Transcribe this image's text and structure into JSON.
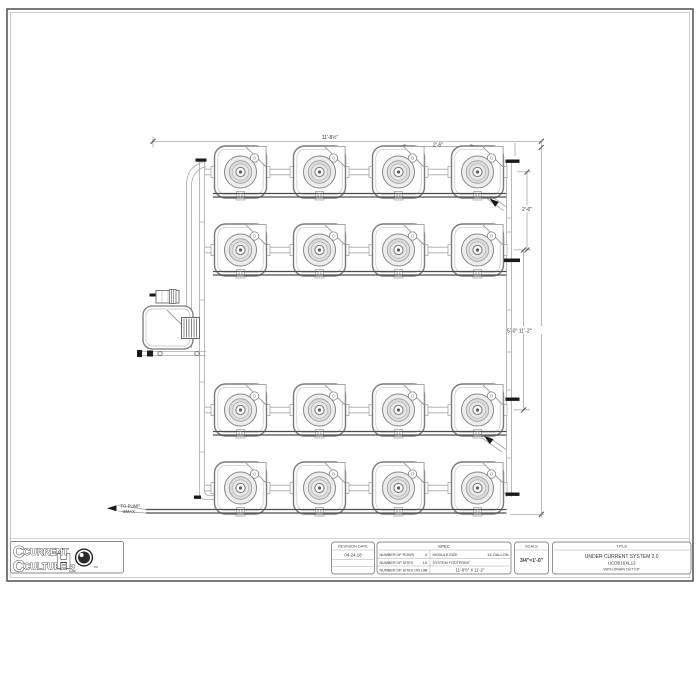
{
  "logo": {
    "word1": "CURRENT",
    "word2": "CULTURE",
    "h2o_h": "H",
    "h2o_sub": "2",
    "tm": "TM"
  },
  "annotations": {
    "dim_overall_width": "11'-8½\"",
    "dim_module_spacing": "2'-6\"",
    "dim_row_spacing": "2'-6\"",
    "dim_center_height": "5'-0\" 11'-2\"",
    "to_pump_line1": "TO PUMP",
    "to_pump_line2": "&MAX"
  },
  "title_block": {
    "revision": {
      "header": "REVISION DATE",
      "date": "04-24-18"
    },
    "spec": {
      "header": "SPEC",
      "left_rows": [
        {
          "label": "NUMBER OF ROWS",
          "value": "4"
        },
        {
          "label": "NUMBER OF SITES",
          "value": "16"
        },
        {
          "label": "NUMBER OF SITES ON LID",
          "value": "4"
        }
      ],
      "right_rows": [
        {
          "label": "MODULE SIZE",
          "value": "13-GALLON"
        },
        {
          "label": "SYSTEM FOOTPRINT",
          "value": "11'-8½\" X 11'-2\""
        }
      ]
    },
    "scale": {
      "header": "SCALE",
      "value": "3/4\"=1'-0\""
    },
    "title": {
      "header": "TITLE",
      "line1": "UNDER CURRENT SYSTEM 2.0",
      "line2": "UCDB16XL13",
      "line3": "WITH DRAIN OUT KIT"
    }
  }
}
